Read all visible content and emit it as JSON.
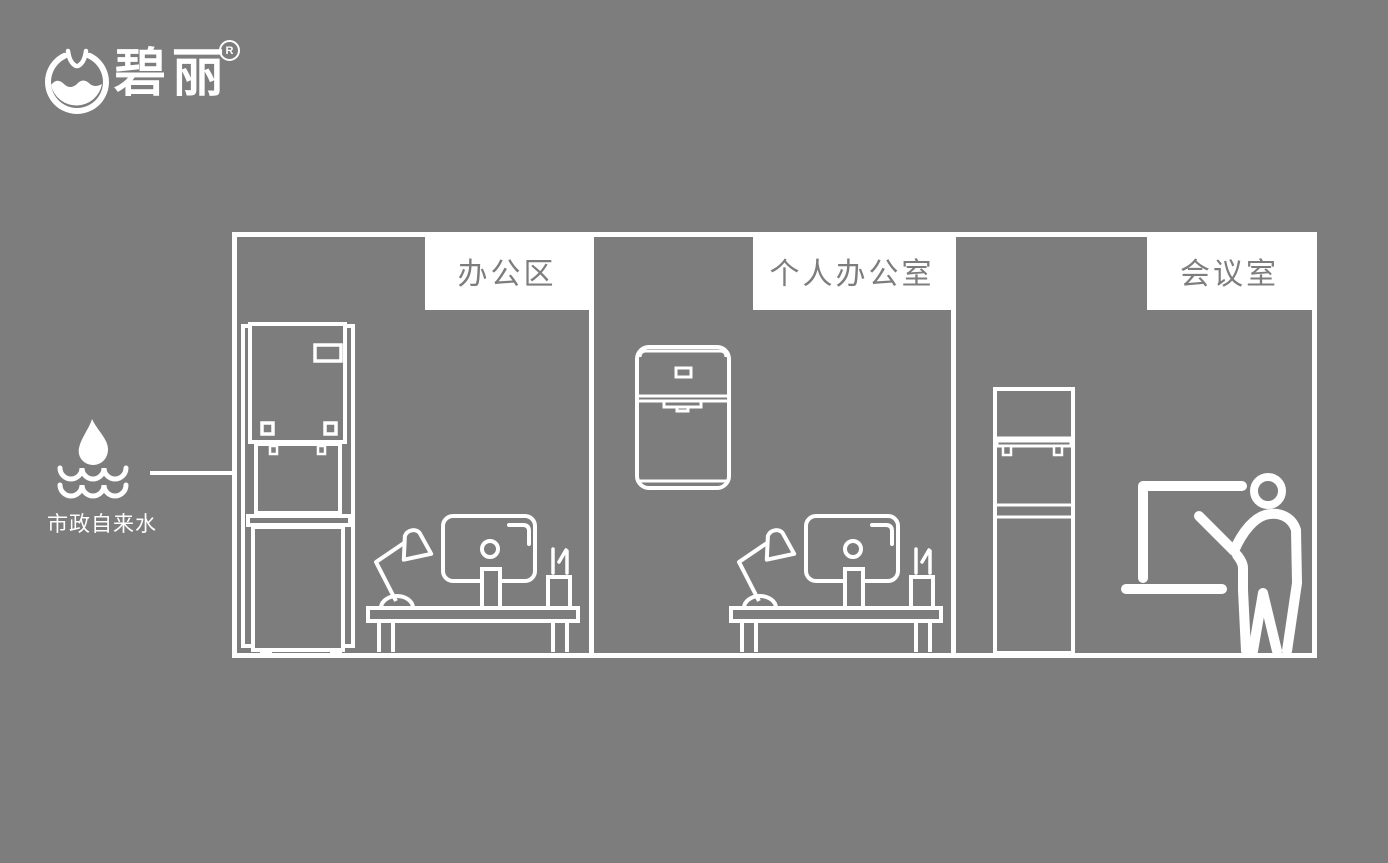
{
  "colors": {
    "background": "#7d7d7d",
    "line": "#ffffff",
    "label_text": "#7d7d7d"
  },
  "logo": {
    "brand": "碧丽",
    "registered_mark": "R"
  },
  "water_source": {
    "label": "市政自来水"
  },
  "rooms": [
    {
      "label": "办公区"
    },
    {
      "label": "个人办公室"
    },
    {
      "label": "会议室"
    }
  ]
}
